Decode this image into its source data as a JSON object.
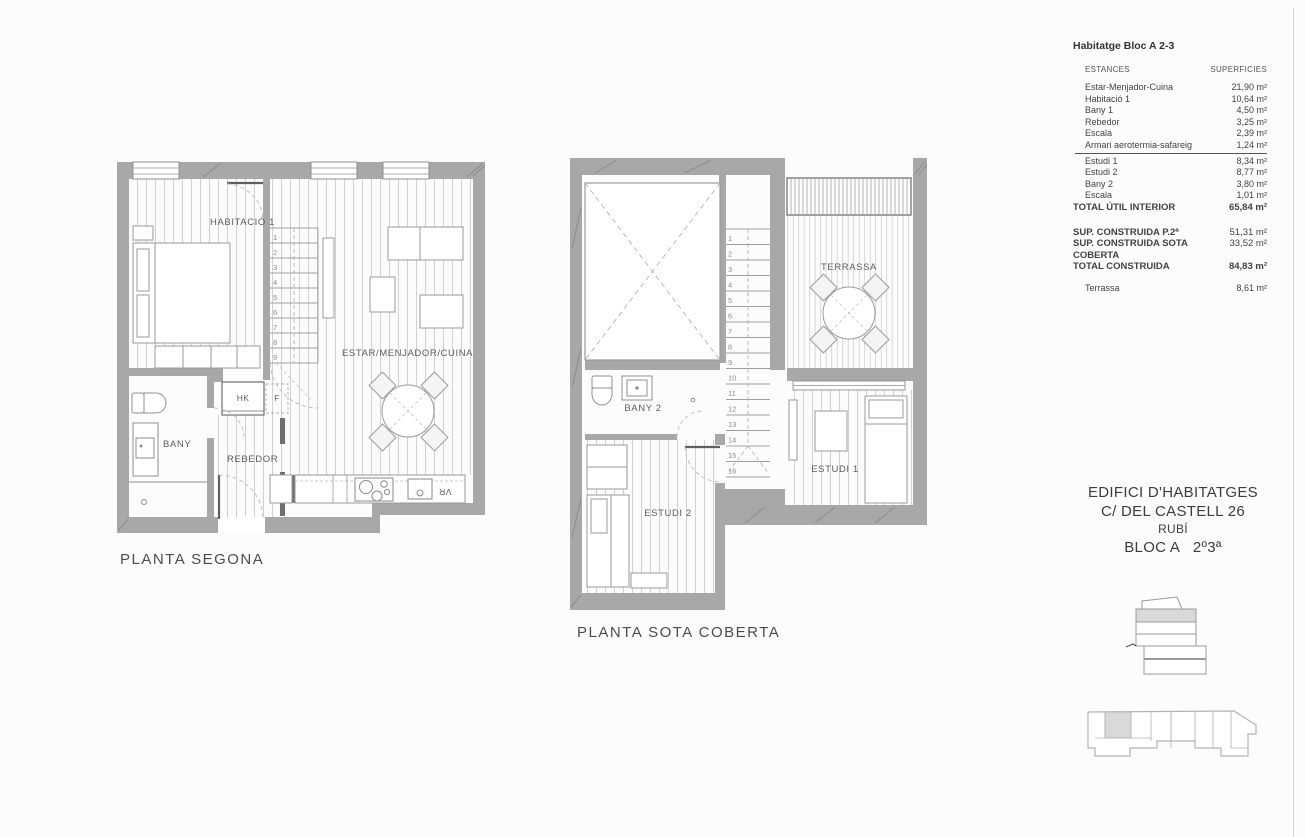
{
  "plan_segona": {
    "caption": "PLANTA SEGONA",
    "rooms": {
      "habitacio1": "HABITACIÓ 1",
      "estar": "ESTAR/MENJADOR/CUINA",
      "bany": "BANY",
      "rebedor": "REBEDOR",
      "hk": "HK",
      "f": "F",
      "vr": "VR"
    },
    "stairs": [
      "1",
      "2",
      "3",
      "4",
      "5",
      "6",
      "7",
      "8",
      "9"
    ]
  },
  "plan_sota_coberta": {
    "caption": "PLANTA SOTA COBERTA",
    "rooms": {
      "bany2": "BANY 2",
      "terrassa": "TERRASSA",
      "estudi1": "ESTUDI 1",
      "estudi2": "ESTUDI 2"
    },
    "stairs": [
      "1",
      "2",
      "3",
      "4",
      "5",
      "6",
      "7",
      "8",
      "9",
      "10",
      "11",
      "12",
      "13",
      "14",
      "15",
      "16"
    ]
  },
  "surface_table": {
    "title": "Habitatge Bloc A 2-3",
    "headers": {
      "estances": "ESTANCES",
      "superficies": "SUPERFICIES"
    },
    "rows_upper": [
      {
        "label": "Estar-Menjador-Cuina",
        "value": "21,90 m²"
      },
      {
        "label": "Habitació 1",
        "value": "10,64 m²"
      },
      {
        "label": "Bany 1",
        "value": "4,50 m²"
      },
      {
        "label": "Rebedor",
        "value": "3,25 m²"
      },
      {
        "label": "Escala",
        "value": "2,39 m²"
      },
      {
        "label": "Armari aerotermia-safareig",
        "value": "1,24 m²"
      }
    ],
    "rows_lower": [
      {
        "label": "Estudi 1",
        "value": "8,34 m²"
      },
      {
        "label": "Estudi 2",
        "value": "8,77 m²"
      },
      {
        "label": "Bany 2",
        "value": "3,80 m²"
      },
      {
        "label": "Escala",
        "value": "1,01 m²"
      }
    ],
    "total_util": {
      "label": "TOTAL ÚTIL INTERIOR",
      "value": "65,84 m²"
    },
    "constructed": [
      {
        "label": "SUP. CONSTRUIDA P.2ª",
        "value": "51,31 m²"
      },
      {
        "label": "SUP. CONSTRUIDA SOTA COBERTA",
        "value": "33,52 m²"
      },
      {
        "label": "TOTAL CONSTRUIDA",
        "value": "84,83 m²"
      }
    ],
    "terrassa_row": {
      "label": "Terrassa",
      "value": "8,61 m²"
    }
  },
  "title_block": {
    "line1": "EDIFICI D'HABITATGES",
    "line2": "C/ DEL CASTELL 26",
    "line3": "RUBÍ",
    "line4": "BLOC A   2º3ª"
  },
  "colors": {
    "wall": "#a8a8a8",
    "hatch": "#c9c9c9",
    "furniture": "#9a9a9a",
    "shaded_unit": "#d9d9d9"
  }
}
